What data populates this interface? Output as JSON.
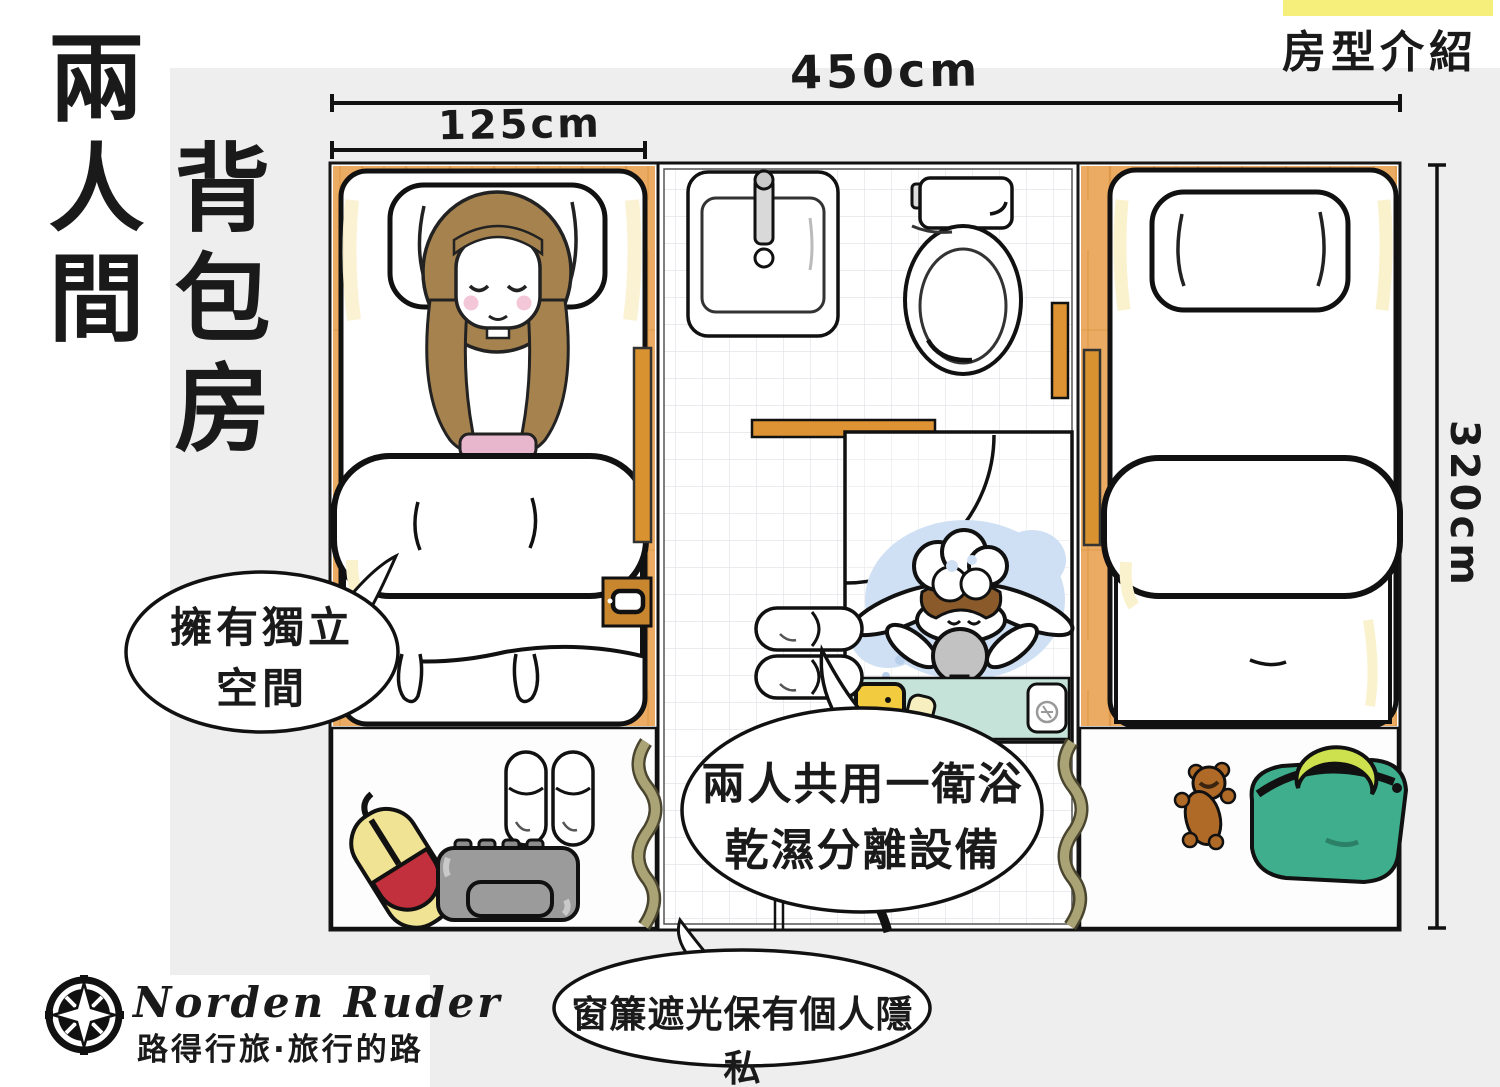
{
  "page": {
    "background": "#ffffff",
    "panel_background": "#eeeeef"
  },
  "header": {
    "room_title_column_1": "兩人間",
    "room_title_column_2": "背包房",
    "corner_tag": "房型介紹"
  },
  "dimensions": {
    "room_width_label": "450cm",
    "bed_width_label": "125cm",
    "room_depth_label": "320cm"
  },
  "speech_bubbles": {
    "left": {
      "line1": "擁有獨立",
      "line2": "空間"
    },
    "center": {
      "line1": "兩人共用一衛浴",
      "line2": "乾濕分離設備"
    },
    "bottom": {
      "text": "窗簾遮光保有個人隱私"
    }
  },
  "footer": {
    "brand_name": "Norden Ruder",
    "brand_tagline": "路得行旅·旅行的路"
  },
  "colors": {
    "highlight_yellow": "#f6ef7b",
    "ink": "#1a1a1a",
    "wood": "#ebab63",
    "wood_grain": "#d9923f",
    "door_wood": "#d8922f",
    "curtain_olive": "#aaa376",
    "shower_shelf_teal": "#c6e3da",
    "water_blue": "#cfe0f4",
    "hair_brown": "#a5824e",
    "wet_hair_brown": "#8a5a2b",
    "blush_pink": "#f3c7d8",
    "shirt_pink": "#e9b7cd",
    "shampoo_yellow": "#f2cc3e",
    "bag_green": "#3fae8c",
    "bag_handle_green": "#cde04d",
    "backpack_red": "#c22f3d",
    "backpack_yellow": "#f1e394",
    "suitcase_gray": "#9b9b9b",
    "teddy_brown": "#b06a28"
  }
}
